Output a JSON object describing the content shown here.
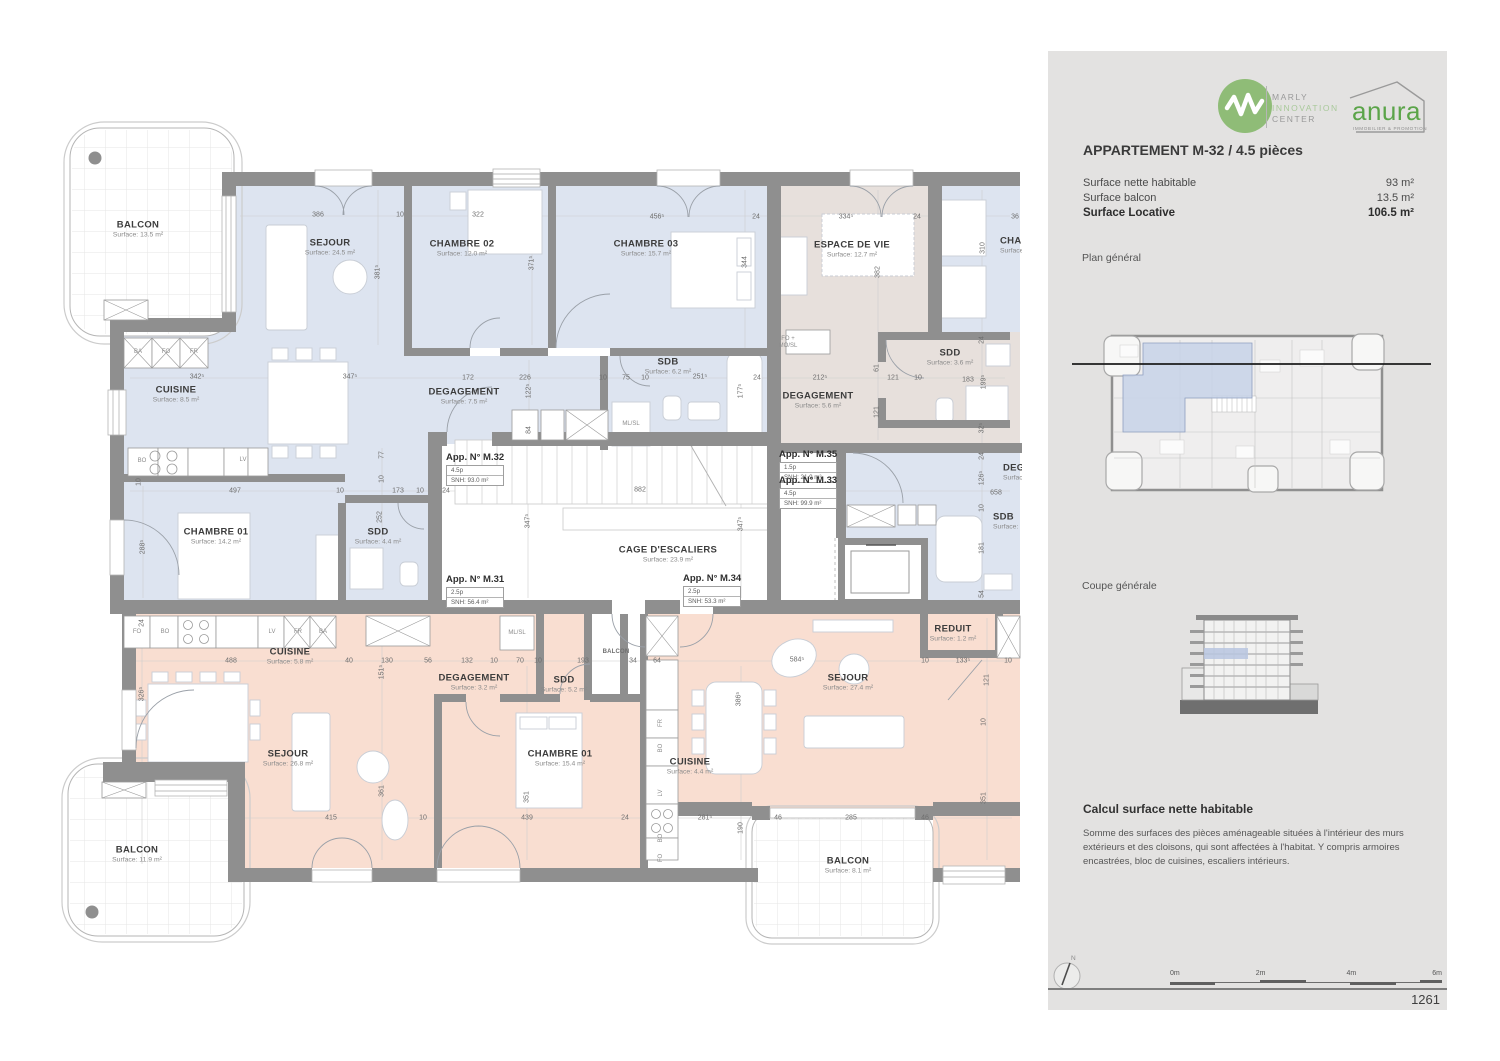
{
  "colors": {
    "blue": "#dde4f0",
    "taupe": "#e7e0dc",
    "orange": "#f9ded1",
    "wall": "#8f8f8f",
    "marly_green": "#8fbc77",
    "anura_green": "#5ba449"
  },
  "panel": {
    "marly_logo": {
      "line1": "MARLY",
      "line2": "INNOVATION",
      "line3": "CENTER"
    },
    "anura_logo": {
      "name": "anura",
      "tagline": "IMMOBILIER & PROMOTION"
    },
    "title": "APPARTEMENT M-32 / 4.5 pièces",
    "surface_rows": [
      {
        "label": "Surface nette habitable",
        "value": "93 m²",
        "bold": false
      },
      {
        "label": "Surface balcon",
        "value": "13.5 m²",
        "bold": false
      },
      {
        "label": "Surface Locative",
        "value": "106.5 m²",
        "bold": true
      }
    ],
    "plan_general_label": "Plan général",
    "coupe_generale_label": "Coupe générale",
    "calc_title": "Calcul surface nette habitable",
    "calc_body": "Somme des surfaces des pièces aménageable situées à l'intérieur des murs extérieurs et des cloisons, qui sont affectées à l'habitat. Y compris armoires encastrées, bloc de cuisines, escaliers intérieurs.",
    "north_label": "N",
    "scale_ticks": [
      "0m",
      "2m",
      "4m",
      "6m"
    ],
    "page_number": "1261"
  },
  "plan": {
    "room_labels": [
      {
        "name": "BALCON",
        "surface": "Surface: 13.5 m²",
        "x": 138,
        "y": 229
      },
      {
        "name": "SEJOUR",
        "surface": "Surface: 24.5 m²",
        "x": 330,
        "y": 247
      },
      {
        "name": "CHAMBRE 02",
        "surface": "Surface: 12.0 m²",
        "x": 462,
        "y": 248
      },
      {
        "name": "CHAMBRE 03",
        "surface": "Surface: 15.7 m²",
        "x": 646,
        "y": 248
      },
      {
        "name": "CUISINE",
        "surface": "Surface: 8.5 m²",
        "x": 176,
        "y": 394
      },
      {
        "name": "DEGAGEMENT",
        "surface": "Surface: 7.5 m²",
        "x": 464,
        "y": 396
      },
      {
        "name": "SDB",
        "surface": "Surface: 6.2 m²",
        "x": 668,
        "y": 366
      },
      {
        "name": "CHAMBRE 01",
        "surface": "Surface: 14.2 m²",
        "x": 216,
        "y": 536
      },
      {
        "name": "SDD",
        "surface": "Surface: 4.4 m²",
        "x": 378,
        "y": 536
      },
      {
        "name": "ESPACE DE VIE",
        "surface": "Surface: 12.7 m²",
        "x": 852,
        "y": 249
      },
      {
        "name": "DEGAGEMENT",
        "surface": "Surface: 5.6 m²",
        "x": 818,
        "y": 400
      },
      {
        "name": "SDD",
        "surface": "Surface: 3.6 m²",
        "x": 950,
        "y": 357
      },
      {
        "name": "CAGE D'ESCALIERS",
        "surface": "Surface: 23.9 m²",
        "x": 668,
        "y": 554
      },
      {
        "name": "CUISINE",
        "surface": "Surface: 5.8 m²",
        "x": 290,
        "y": 656
      },
      {
        "name": "DEGAGEMENT",
        "surface": "Surface: 3.2 m²",
        "x": 474,
        "y": 682
      },
      {
        "name": "SDD",
        "surface": "Surface: 5.2 m²",
        "x": 564,
        "y": 684
      },
      {
        "name": "SEJOUR",
        "surface": "Surface: 26.8 m²",
        "x": 288,
        "y": 758
      },
      {
        "name": "CHAMBRE 01",
        "surface": "Surface: 15.4 m²",
        "x": 560,
        "y": 758
      },
      {
        "name": "BALCON",
        "surface": "Surface: 11.9 m²",
        "x": 137,
        "y": 854
      },
      {
        "name": "CUISINE",
        "surface": "Surface: 4.4 m²",
        "x": 690,
        "y": 766
      },
      {
        "name": "SEJOUR",
        "surface": "Surface: 27.4 m²",
        "x": 848,
        "y": 682
      },
      {
        "name": "REDUIT",
        "surface": "Surface: 1.2 m²",
        "x": 953,
        "y": 633
      },
      {
        "name": "BALCON",
        "surface": "Surface: 8.1 m²",
        "x": 848,
        "y": 865
      },
      {
        "name": "BALCON",
        "x": 616,
        "y": 652,
        "small": true
      },
      {
        "name": "CHAMBRE",
        "surface": "Surface:",
        "x": 1000,
        "y": 245,
        "align": "left"
      },
      {
        "name": "DEGAGEMENT",
        "surface": "Surface:",
        "x": 1003,
        "y": 472,
        "align": "left"
      },
      {
        "name": "SDB",
        "surface": "Surface:",
        "x": 993,
        "y": 521,
        "align": "left"
      }
    ],
    "apartment_tags": [
      {
        "title": "App. N° M.32",
        "pieces": "4.5p",
        "snh": "SNH: 93.0 m²",
        "x": 446,
        "y": 452
      },
      {
        "title": "App. N° M.31",
        "pieces": "2.5p",
        "snh": "SNH: 56.4 m²",
        "x": 446,
        "y": 574
      },
      {
        "title": "App. N° M.34",
        "pieces": "2.5p",
        "snh": "SNH: 53.3 m²",
        "x": 683,
        "y": 573
      },
      {
        "title": "App. N° M.35",
        "pieces": "1.5p",
        "snh": "SNH: 21.9 m²",
        "x": 779,
        "y": 449
      },
      {
        "title": "App. N° M.33",
        "pieces": "4.5p",
        "snh": "SNH: 99.9 m²",
        "x": 779,
        "y": 475
      }
    ],
    "dimensions": [
      {
        "t": "386",
        "x": 318,
        "y": 215
      },
      {
        "t": "10",
        "x": 400,
        "y": 215
      },
      {
        "t": "322",
        "x": 478,
        "y": 215
      },
      {
        "t": "456⁵",
        "x": 657,
        "y": 217
      },
      {
        "t": "24",
        "x": 756,
        "y": 217
      },
      {
        "t": "334⁵",
        "x": 846,
        "y": 217
      },
      {
        "t": "24",
        "x": 917,
        "y": 217
      },
      {
        "t": "36",
        "x": 1015,
        "y": 217
      },
      {
        "t": "381⁵",
        "x": 378,
        "y": 272,
        "v": true
      },
      {
        "t": "371⁵",
        "x": 532,
        "y": 263,
        "v": true
      },
      {
        "t": "344",
        "x": 745,
        "y": 262,
        "v": true
      },
      {
        "t": "310",
        "x": 983,
        "y": 248,
        "v": true
      },
      {
        "t": "382",
        "x": 878,
        "y": 272,
        "v": true
      },
      {
        "t": "342⁵",
        "x": 197,
        "y": 377
      },
      {
        "t": "347⁵",
        "x": 350,
        "y": 377
      },
      {
        "t": "172",
        "x": 468,
        "y": 378
      },
      {
        "t": "226",
        "x": 525,
        "y": 378
      },
      {
        "t": "10",
        "x": 603,
        "y": 378
      },
      {
        "t": "75",
        "x": 626,
        "y": 378
      },
      {
        "t": "10",
        "x": 645,
        "y": 378
      },
      {
        "t": "251⁵",
        "x": 700,
        "y": 377
      },
      {
        "t": "24",
        "x": 757,
        "y": 378
      },
      {
        "t": "212⁵",
        "x": 820,
        "y": 378
      },
      {
        "t": "121",
        "x": 893,
        "y": 378
      },
      {
        "t": "10",
        "x": 918,
        "y": 378
      },
      {
        "t": "183",
        "x": 968,
        "y": 380
      },
      {
        "t": "122⁵",
        "x": 529,
        "y": 391,
        "v": true
      },
      {
        "t": "84",
        "x": 529,
        "y": 430,
        "v": true
      },
      {
        "t": "177⁵",
        "x": 741,
        "y": 391,
        "v": true
      },
      {
        "t": "61",
        "x": 877,
        "y": 368,
        "v": true
      },
      {
        "t": "121",
        "x": 877,
        "y": 412,
        "v": true
      },
      {
        "t": "199⁵",
        "x": 984,
        "y": 382,
        "v": true
      },
      {
        "t": "24",
        "x": 982,
        "y": 340,
        "v": true
      },
      {
        "t": "32⁵",
        "x": 982,
        "y": 428,
        "v": true
      },
      {
        "t": "24",
        "x": 982,
        "y": 456,
        "v": true
      },
      {
        "t": "126⁵",
        "x": 982,
        "y": 478,
        "v": true
      },
      {
        "t": "10",
        "x": 982,
        "y": 508,
        "v": true
      },
      {
        "t": "181",
        "x": 982,
        "y": 548,
        "v": true
      },
      {
        "t": "54",
        "x": 982,
        "y": 594,
        "v": true
      },
      {
        "t": "497",
        "x": 235,
        "y": 491
      },
      {
        "t": "10",
        "x": 340,
        "y": 491
      },
      {
        "t": "173",
        "x": 398,
        "y": 491
      },
      {
        "t": "10",
        "x": 420,
        "y": 491
      },
      {
        "t": "24",
        "x": 446,
        "y": 491
      },
      {
        "t": "882",
        "x": 640,
        "y": 490
      },
      {
        "t": "658",
        "x": 996,
        "y": 493
      },
      {
        "t": "288⁵",
        "x": 143,
        "y": 547,
        "v": true
      },
      {
        "t": "77",
        "x": 382,
        "y": 455,
        "v": true
      },
      {
        "t": "10",
        "x": 382,
        "y": 479,
        "v": true
      },
      {
        "t": "252",
        "x": 380,
        "y": 517,
        "v": true
      },
      {
        "t": "10",
        "x": 139,
        "y": 482,
        "v": true
      },
      {
        "t": "347⁵",
        "x": 528,
        "y": 521,
        "v": true
      },
      {
        "t": "347⁵",
        "x": 741,
        "y": 524,
        "v": true
      },
      {
        "t": "488",
        "x": 231,
        "y": 661
      },
      {
        "t": "40",
        "x": 349,
        "y": 661
      },
      {
        "t": "130",
        "x": 387,
        "y": 661
      },
      {
        "t": "56",
        "x": 428,
        "y": 661
      },
      {
        "t": "132",
        "x": 467,
        "y": 661
      },
      {
        "t": "10",
        "x": 494,
        "y": 661
      },
      {
        "t": "70",
        "x": 520,
        "y": 661
      },
      {
        "t": "10",
        "x": 538,
        "y": 661
      },
      {
        "t": "193",
        "x": 583,
        "y": 661
      },
      {
        "t": "34",
        "x": 633,
        "y": 661
      },
      {
        "t": "64",
        "x": 657,
        "y": 661
      },
      {
        "t": "584⁵",
        "x": 797,
        "y": 660
      },
      {
        "t": "10",
        "x": 925,
        "y": 661
      },
      {
        "t": "133⁵",
        "x": 963,
        "y": 661
      },
      {
        "t": "10",
        "x": 1008,
        "y": 661
      },
      {
        "t": "151⁵",
        "x": 382,
        "y": 672,
        "v": true
      },
      {
        "t": "326⁵",
        "x": 142,
        "y": 694,
        "v": true
      },
      {
        "t": "24",
        "x": 142,
        "y": 623,
        "v": true
      },
      {
        "t": "386⁵",
        "x": 739,
        "y": 699,
        "v": true
      },
      {
        "t": "121",
        "x": 987,
        "y": 680,
        "v": true
      },
      {
        "t": "415",
        "x": 331,
        "y": 818
      },
      {
        "t": "10",
        "x": 423,
        "y": 818
      },
      {
        "t": "439",
        "x": 527,
        "y": 818
      },
      {
        "t": "24",
        "x": 625,
        "y": 818
      },
      {
        "t": "281⁵",
        "x": 705,
        "y": 818
      },
      {
        "t": "46",
        "x": 778,
        "y": 818
      },
      {
        "t": "285",
        "x": 851,
        "y": 818
      },
      {
        "t": "46",
        "x": 925,
        "y": 818
      },
      {
        "t": "361",
        "x": 382,
        "y": 791,
        "v": true
      },
      {
        "t": "351",
        "x": 527,
        "y": 797,
        "v": true
      },
      {
        "t": "190",
        "x": 741,
        "y": 828,
        "v": true
      },
      {
        "t": "351",
        "x": 984,
        "y": 798,
        "v": true
      },
      {
        "t": "10",
        "x": 984,
        "y": 722,
        "v": true
      }
    ],
    "tiny_labels": [
      {
        "t": "BA",
        "x": 138,
        "y": 352
      },
      {
        "t": "FO",
        "x": 166,
        "y": 352
      },
      {
        "t": "FR",
        "x": 194,
        "y": 352
      },
      {
        "t": "BO",
        "x": 142,
        "y": 461
      },
      {
        "t": "LV",
        "x": 243,
        "y": 460
      },
      {
        "t": "ML/SL",
        "x": 631,
        "y": 424
      },
      {
        "t": "FO",
        "x": 137,
        "y": 632
      },
      {
        "t": "BO",
        "x": 165,
        "y": 632
      },
      {
        "t": "LV",
        "x": 272,
        "y": 632
      },
      {
        "t": "FR",
        "x": 298,
        "y": 632
      },
      {
        "t": "BA",
        "x": 323,
        "y": 632
      },
      {
        "t": "ML/SL",
        "x": 517,
        "y": 633
      },
      {
        "t": "FR",
        "x": 661,
        "y": 723,
        "v": true
      },
      {
        "t": "BO",
        "x": 661,
        "y": 748,
        "v": true
      },
      {
        "t": "LV",
        "x": 661,
        "y": 793,
        "v": true
      },
      {
        "t": "BO",
        "x": 661,
        "y": 838,
        "v": true
      },
      {
        "t": "FO",
        "x": 661,
        "y": 858,
        "v": true
      },
      {
        "t": "FO +",
        "x": 788,
        "y": 339
      },
      {
        "t": "MO/SL",
        "x": 788,
        "y": 346
      }
    ]
  }
}
